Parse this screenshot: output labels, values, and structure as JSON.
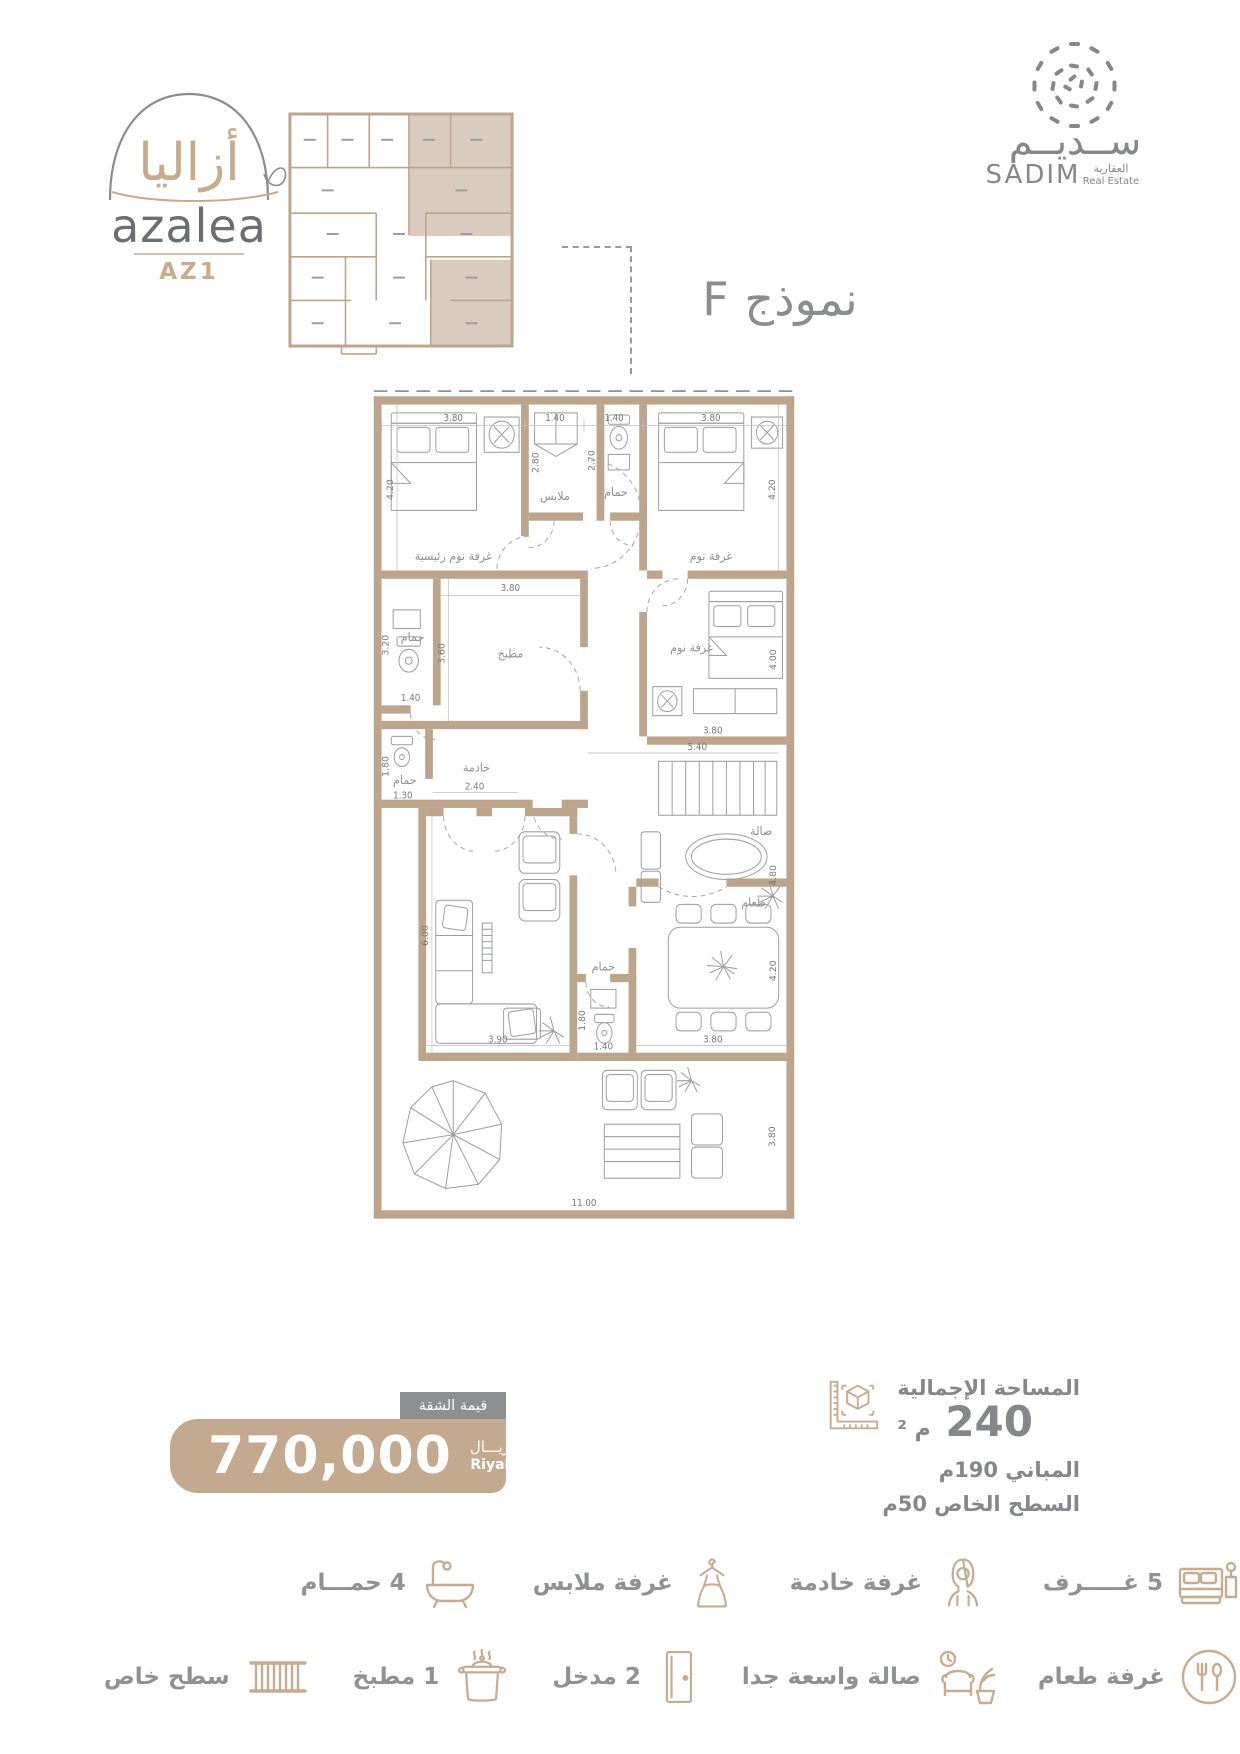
{
  "logo": {
    "brand_ar": "أزاليا",
    "brand_en": "azalea",
    "unit": "AZ1"
  },
  "developer": {
    "name_ar": "ســديــم",
    "name_en": "SADIM",
    "tagline_ar": "العقارية",
    "tagline_en": "Real Estate"
  },
  "model": {
    "label": "نموذج F"
  },
  "plan": {
    "labels": {
      "master": "غرفة نوم رئيسية",
      "closet": "ملابس",
      "bath": "حمام",
      "bedroom": "غرفة نوم",
      "kitchen": "مطبخ",
      "maid": "خادمة",
      "salon": "صالة",
      "dining": "طعام"
    },
    "dims": {
      "d380": "3.80",
      "d140": "1.40",
      "d420": "4.20",
      "d280": "2.80",
      "d270": "2.70",
      "d360": "3.60",
      "d320": "3.20",
      "d180": "1.80",
      "d130": "1.30",
      "d240": "2.40",
      "d400": "4.00",
      "d540": "5.40",
      "d480": "4.80",
      "d600": "6.00",
      "d390": "3.90",
      "d1100": "11.00"
    }
  },
  "price": {
    "tab": "قيمة الشقة",
    "amount": "770,000",
    "currency_ar": "ريـــال",
    "currency_en": "Riyal"
  },
  "area": {
    "total_label": "المساحة الإجمالية",
    "total_value": "240",
    "total_unit": "م ²",
    "built_label": "المباني 190م",
    "roof_label": "السطح الخاص 50م"
  },
  "features_row1": [
    {
      "label": "5 غـــــرف"
    },
    {
      "label": "غرفة خادمة"
    },
    {
      "label": "غرفة ملابس"
    },
    {
      "label": "4 حمـــام"
    }
  ],
  "features_row2": [
    {
      "label": "غرفة طعام"
    },
    {
      "label": "صالة واسعة جدا"
    },
    {
      "label": "2 مدخل"
    },
    {
      "label": "1 مطبخ"
    },
    {
      "label": "سطح خاص"
    }
  ]
}
